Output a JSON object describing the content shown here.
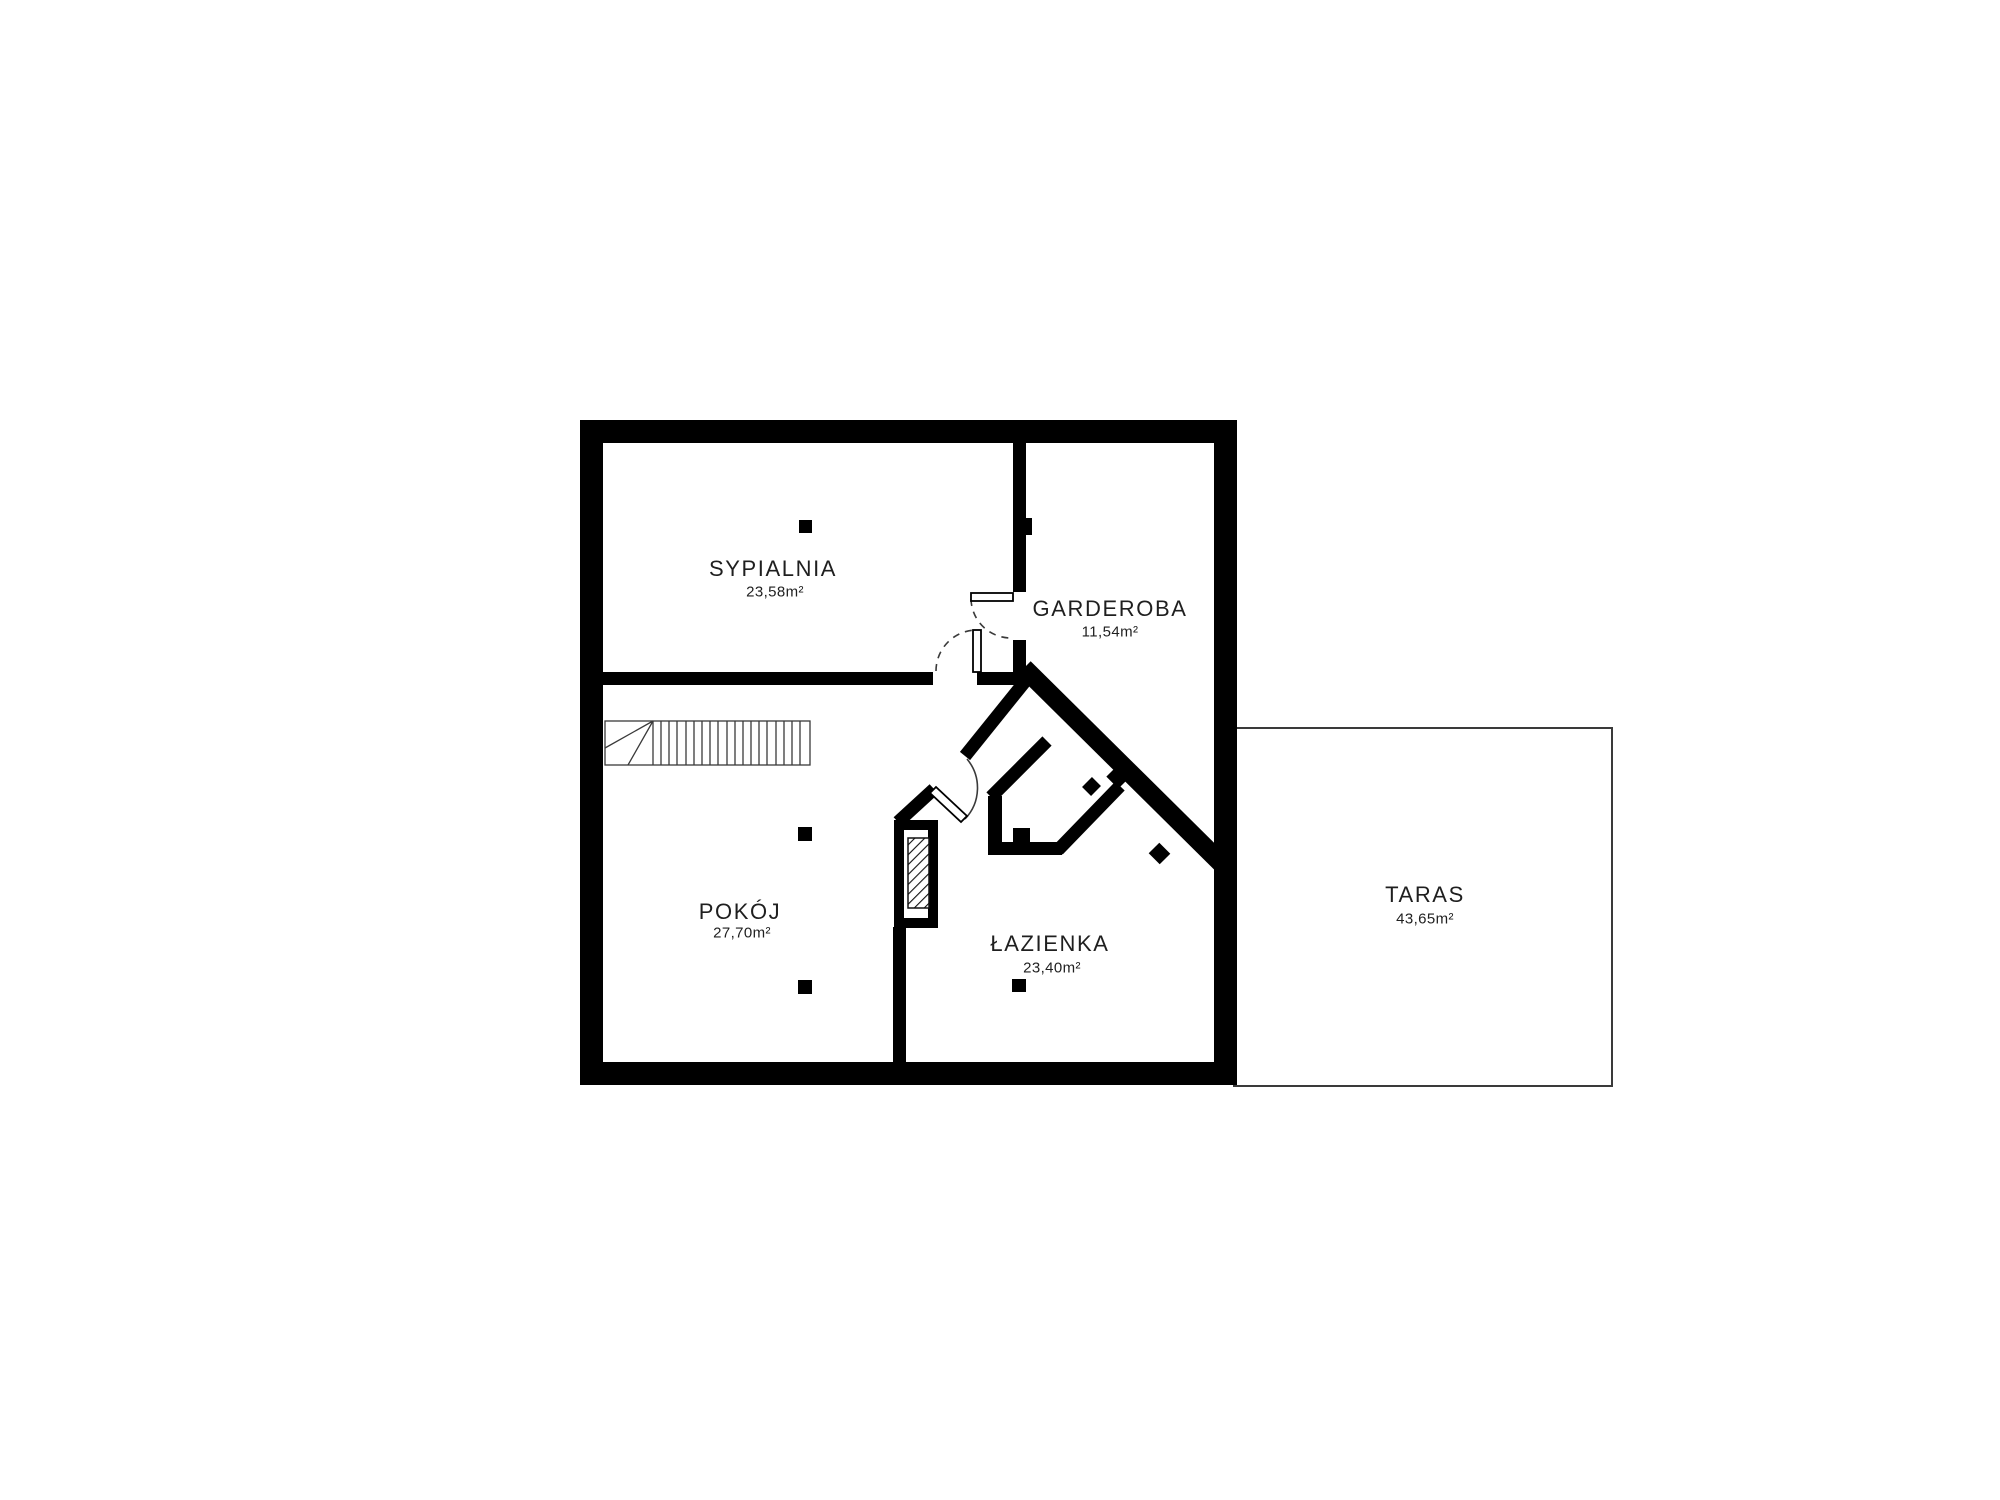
{
  "plan": {
    "title": "floor-plan",
    "colors": {
      "wall": "#000000",
      "thin_line": "#3a3a3a",
      "text": "#1f1f1f",
      "background": "#ffffff"
    },
    "rooms": [
      {
        "name": "SYPIALNIA",
        "area": "23,58m²"
      },
      {
        "name": "GARDEROBA",
        "area": "11,54m²"
      },
      {
        "name": "POKÓJ",
        "area": "27,70m²"
      },
      {
        "name": "ŁAZIENKA",
        "area": "23,40m²"
      },
      {
        "name": "TARAS",
        "area": "43,65m²"
      }
    ]
  }
}
